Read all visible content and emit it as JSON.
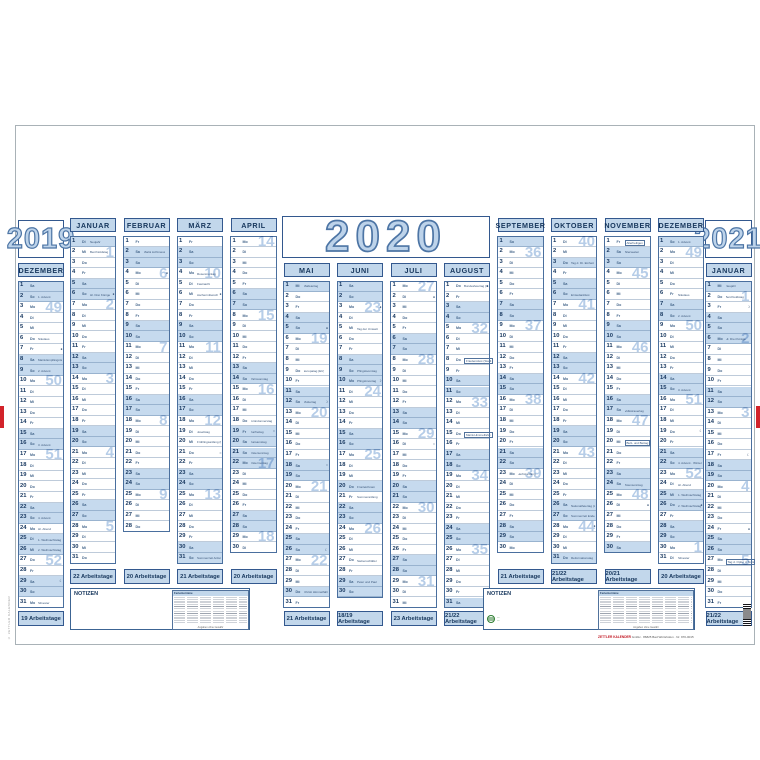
{
  "calendar": {
    "title_year": "2020",
    "left_year": "2019",
    "right_year": "2021",
    "weekdays": [
      "Mo",
      "Di",
      "Mi",
      "Do",
      "Fr",
      "Sa",
      "So"
    ],
    "notizen_label": "NOTIZEN",
    "ferientermine_title": "Ferientermine",
    "ferientermine_caption": "Angaben ohne Gewähr",
    "imprint": {
      "brand": "ZETTLER KALENDER",
      "rest": " GmbH · 86825 Bad Wörishofen · Nr. 970-0015"
    },
    "side_imprint": "© ZETTLER KALENDER",
    "colors": {
      "accent": "#33588e",
      "weekend_fill": "#c6daee",
      "header_fill": "#c2d7eb",
      "year_digits": "#bdd3ea",
      "year_outline": "#4d75a5",
      "red": "#d2232a",
      "green": "#2e7d32"
    },
    "months": [
      {
        "slot": "L",
        "name": "DEZEMBER",
        "days": 31,
        "first": 5,
        "work": "19 Arbeitstage",
        "weeks": {
          "3": 49,
          "10": 50,
          "17": 51,
          "27": 52
        },
        "ann": {
          "2": {
            "t": "1. Advent"
          },
          "6": {
            "t": "Nikolaus"
          },
          "8": {
            "t": "Mariä Empfängnis",
            "hl": true
          },
          "9": {
            "t": "2. Advent"
          },
          "16": {
            "t": "3. Advent"
          },
          "23": {
            "t": "4. Advent"
          },
          "24": {
            "t": "Hl. Abend"
          },
          "25": {
            "t": "1. Weihnachtstag",
            "hl": true
          },
          "26": {
            "t": "2. Weihnachtstag",
            "hl": true
          },
          "31": {
            "t": "Silvester"
          }
        },
        "moons": {
          "7": "●",
          "29": "☾"
        }
      },
      {
        "slot": "A1",
        "name": "JANUAR",
        "days": 31,
        "first": 1,
        "work": "22 Arbeitstage",
        "weeks": {
          "2": 1,
          "7": 2,
          "14": 3,
          "21": 4,
          "28": 5
        },
        "ann": {
          "1": {
            "t": "Neujahr",
            "hl": true
          },
          "2": {
            "t": "Berchtoldstag"
          },
          "6": {
            "t": "Hl. Drei Könige",
            "hl": true
          }
        },
        "moons": {
          "6": "●"
        }
      },
      {
        "slot": "A2",
        "name": "FEBRUAR",
        "days": 28,
        "first": 4,
        "work": "20 Arbeitstage",
        "weeks": {
          "4": 6,
          "11": 7,
          "18": 8,
          "25": 9
        },
        "ann": {
          "2": {
            "t": "Mariä Lichtmess"
          }
        },
        "moons": {
          "4": "●"
        }
      },
      {
        "slot": "A3",
        "name": "MÄRZ",
        "days": 31,
        "first": 4,
        "work": "21 Arbeitstage",
        "weeks": {
          "4": 10,
          "11": 11,
          "18": 12,
          "25": 13
        },
        "ann": {
          "4": {
            "t": "Rosenmontag"
          },
          "5": {
            "t": "Fastnacht"
          },
          "6": {
            "t": "Aschermittwoch"
          },
          "19": {
            "t": "Josefstag"
          },
          "20": {
            "t": "Frühlingsanfang (MEZ)"
          },
          "31": {
            "t": "Sommerzeit Anfang"
          }
        },
        "moons": {
          "6": "●",
          "21": "○"
        }
      },
      {
        "slot": "A4",
        "name": "APRIL",
        "days": 30,
        "first": 0,
        "work": "20 Arbeitstage",
        "weeks": {
          "1": 14,
          "8": 15,
          "15": 16,
          "22": 17,
          "29": 18
        },
        "ann": {
          "14": {
            "t": "Palmsonntag"
          },
          "18": {
            "t": "Gründonnerstag"
          },
          "19": {
            "t": "Karfreitag",
            "hl": true
          },
          "20": {
            "t": "Karsamstag"
          },
          "21": {
            "t": "Ostersonntag"
          },
          "22": {
            "t": "Ostermontag",
            "hl": true
          }
        },
        "moons": {
          "19": "○"
        }
      },
      {
        "slot": "M1",
        "name": "MAI",
        "days": 31,
        "first": 2,
        "work": "21 Arbeitstage",
        "weeks": {
          "6": 19,
          "13": 20,
          "20": 21,
          "27": 22
        },
        "ann": {
          "1": {
            "t": "Maifeiertag",
            "hl": true
          },
          "9": {
            "t": "Europatag (EU)"
          },
          "12": {
            "t": "Muttertag"
          },
          "30": {
            "t": "Christi Himmelfahrt",
            "hl": true
          }
        },
        "moons": {
          "5": "●",
          "12": "☽",
          "18": "○",
          "26": "☾"
        }
      },
      {
        "slot": "M2",
        "name": "JUNI",
        "days": 30,
        "first": 5,
        "work": "18/19 Arbeitstage",
        "weeks": {
          "3": 23,
          "11": 24,
          "17": 25,
          "24": 26
        },
        "ann": {
          "5": {
            "t": "Tag der Umwelt"
          },
          "9": {
            "t": "Pfingstsonntag"
          },
          "10": {
            "t": "Pfingstmontag",
            "hl": true
          },
          "20": {
            "t": "Fronleichnam",
            "hl": true
          },
          "21": {
            "t": "Sommeranfang"
          },
          "27": {
            "t": "Siebenschläfer"
          },
          "29": {
            "t": "Peter und Paul"
          }
        },
        "moons": {
          "3": "●",
          "10": "☽"
        }
      },
      {
        "slot": "M3",
        "name": "JULI",
        "days": 31,
        "first": 0,
        "work": "23 Arbeitstage",
        "weeks": {
          "1": 27,
          "8": 28,
          "15": 29,
          "22": 30,
          "29": 31
        },
        "ann": {},
        "moons": {
          "2": "●",
          "16": "○"
        }
      },
      {
        "slot": "M4",
        "name": "AUGUST",
        "days": 31,
        "first": 3,
        "work": "21/22 Arbeitstage",
        "weeks": {
          "5": 32,
          "12": 33,
          "19": 34,
          "26": 35
        },
        "ann": {
          "1": {
            "t": "Bundesfeiertag (CH)"
          },
          "8": {
            "t": "Friedensfest (Stadt Augsburg)",
            "box": true
          },
          "15": {
            "t": "Mariä Himmelfahrt",
            "box": true
          }
        },
        "moons": {
          "1": "●",
          "30": "●"
        }
      },
      {
        "slot": "B1",
        "name": "SEPTEMBER",
        "days": 30,
        "first": 6,
        "work": "21 Arbeitstage",
        "weeks": {
          "2": 36,
          "9": 37,
          "16": 38,
          "23": 39
        },
        "ann": {
          "23": {
            "t": "Herbstanfang"
          }
        },
        "moons": {}
      },
      {
        "slot": "B2",
        "name": "OKTOBER",
        "days": 31,
        "first": 1,
        "work": "21/22 Arbeitstage",
        "weeks": {
          "1": 40,
          "7": 41,
          "14": 42,
          "21": 43,
          "28": 44
        },
        "ann": {
          "3": {
            "t": "Tag d. Dt. Einheit",
            "hl": true
          },
          "6": {
            "t": "Erntedankfest"
          },
          "26": {
            "t": "Nationalfeiertag (A)"
          },
          "27": {
            "t": "Sommerzeit Ende"
          },
          "31": {
            "t": "Reformationstag",
            "hl": true
          }
        },
        "moons": {
          "28": "●"
        }
      },
      {
        "slot": "B3",
        "name": "NOVEMBER",
        "days": 30,
        "first": 4,
        "work": "20/21 Arbeitstage",
        "weeks": {
          "4": 45,
          "11": 46,
          "18": 47,
          "25": 48
        },
        "ann": {
          "1": {
            "t": "Allerheiligen",
            "box": true
          },
          "2": {
            "t": "Allerseelen"
          },
          "17": {
            "t": "Volkstrauertag"
          },
          "20": {
            "t": "Buß- und Bettag",
            "box": true
          },
          "24": {
            "t": "Totensonntag"
          }
        },
        "moons": {
          "26": "●"
        }
      },
      {
        "slot": "B4",
        "name": "DEZEMBER",
        "days": 31,
        "first": 6,
        "work": "20 Arbeitstage",
        "weeks": {
          "2": 49,
          "9": 50,
          "16": 51,
          "23": 52,
          "30": 1
        },
        "ann": {
          "1": {
            "t": "1. Advent"
          },
          "6": {
            "t": "Nikolaus"
          },
          "8": {
            "t": "2. Advent"
          },
          "15": {
            "t": "3. Advent"
          },
          "22": {
            "t": "4. Advent · Winteranfang"
          },
          "24": {
            "t": "Hl. Abend"
          },
          "25": {
            "t": "1. Weihnachtstag",
            "hl": true
          },
          "26": {
            "t": "2. Weihnachtstag",
            "hl": true
          },
          "31": {
            "t": "Silvester"
          }
        },
        "moons": {
          "19": "☾",
          "26": "●"
        }
      },
      {
        "slot": "R",
        "name": "JANUAR",
        "days": 31,
        "first": 2,
        "work": "21/22 Arbeitstage",
        "weeks": {
          "2": 1,
          "6": 2,
          "13": 3,
          "20": 4,
          "27": 5
        },
        "ann": {
          "1": {
            "t": "Neujahr",
            "hl": true
          },
          "2": {
            "t": "Berchtoldstag"
          },
          "6": {
            "t": "Hl. Drei Könige",
            "hl": true
          },
          "27": {
            "t": "Tag d. Opfer d. Nationalsoz.",
            "box": true
          }
        },
        "moons": {
          "3": "☽",
          "17": "☾",
          "24": "●"
        }
      }
    ]
  }
}
